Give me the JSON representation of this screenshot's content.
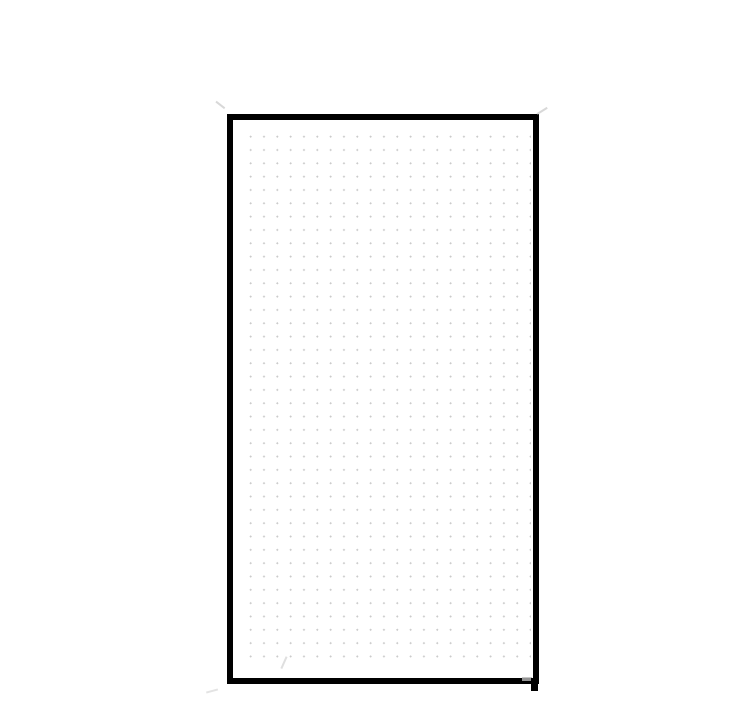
{
  "canvas": {
    "background_color": "#ffffff",
    "content": "blank drawing canvas containing one shape, no visible text"
  },
  "shape": {
    "type": "rectangle",
    "style": "hand-drawn",
    "stroke_color": "#000000",
    "stroke_width_px": 6,
    "fill_pattern": "dot-grid",
    "bounds_px": {
      "left": 227,
      "top": 114,
      "width": 312,
      "height": 570
    }
  },
  "dot_grid": {
    "dot_color": "#cbcbcb",
    "dot_size_px": 2,
    "spacing_px": 13.3,
    "columns": 22,
    "rows": 40
  },
  "artifacts": {
    "description": "faint sketch overshoot ticks at corners and small black overshoot at bottom-right corner",
    "tick_color": "#b8b8b8"
  },
  "colors": {
    "canvas_bg": "#ffffff",
    "shape_stroke": "#000000",
    "dot": "#cbcbcb",
    "artifact": "#b8b8b8"
  }
}
